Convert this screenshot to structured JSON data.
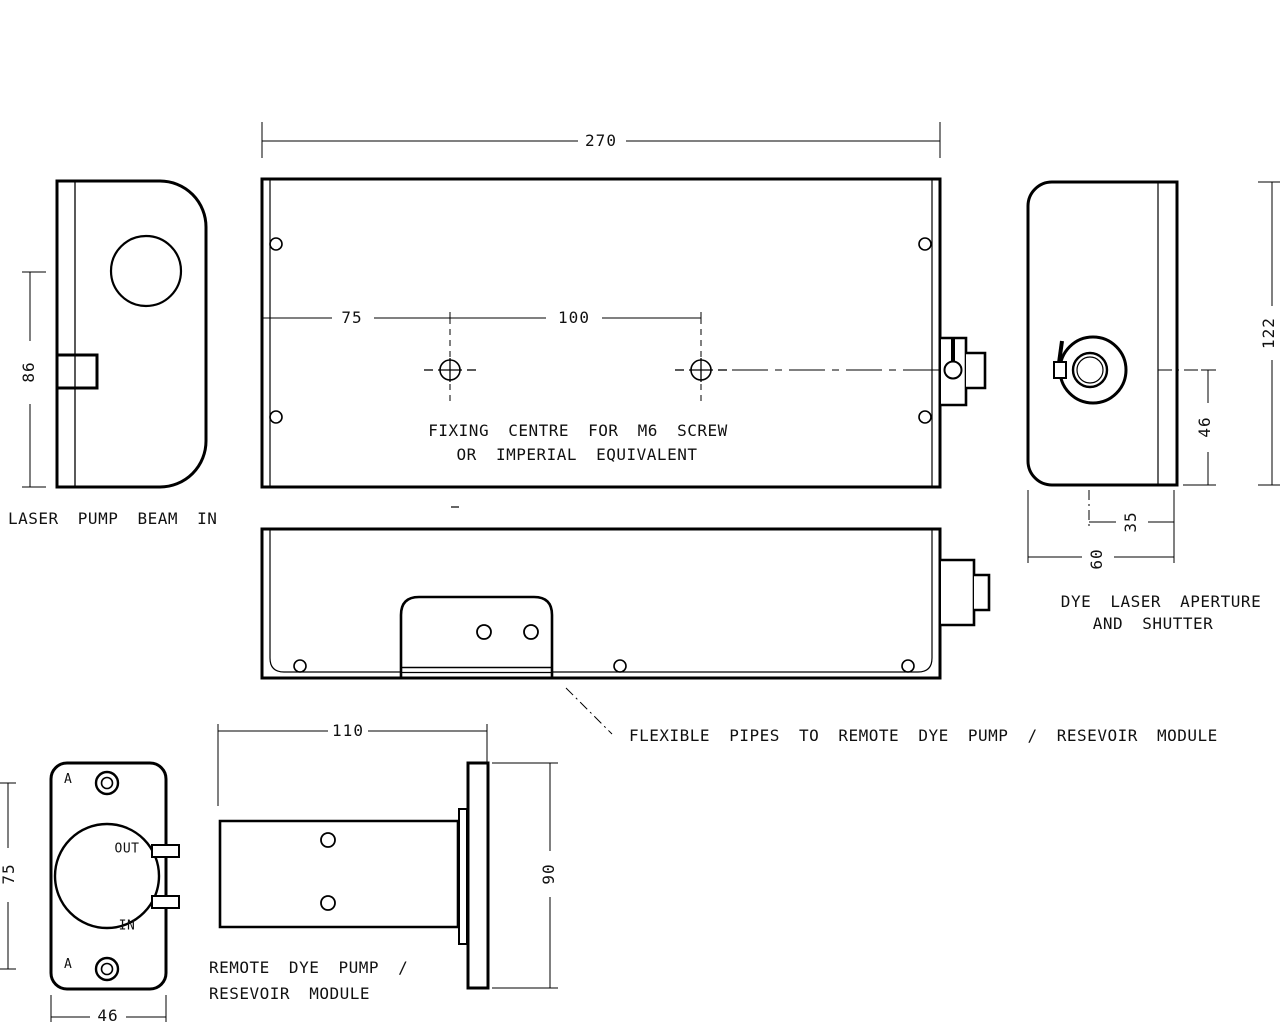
{
  "views": {
    "side": {
      "label": "LASER PUMP BEAM IN",
      "height": "86"
    },
    "top": {
      "width": "270",
      "fix_offset": "75",
      "fix_spacing": "100",
      "note1": "FIXING CENTRE FOR M6 SCREW",
      "note2": "OR IMPERIAL EQUIVALENT"
    },
    "end": {
      "label1": "DYE LASER APERTURE",
      "label2": "AND SHUTTER",
      "height": "122",
      "center_to_base": "46",
      "center_to_face": "35",
      "depth": "60"
    },
    "bottom": {
      "note": "FLEXIBLE PIPES TO REMOTE DYE PUMP / RESEVOIR MODULE"
    },
    "pump_front": {
      "hole_spacing": "75",
      "width": "46",
      "out": "OUT",
      "in": "IN",
      "datum": "A"
    },
    "pump_side": {
      "label1": "REMOTE DYE PUMP /",
      "label2": "RESEVOIR MODULE",
      "length": "110",
      "height": "90"
    }
  },
  "colors": {
    "line": "#000000",
    "background": "#ffffff"
  }
}
